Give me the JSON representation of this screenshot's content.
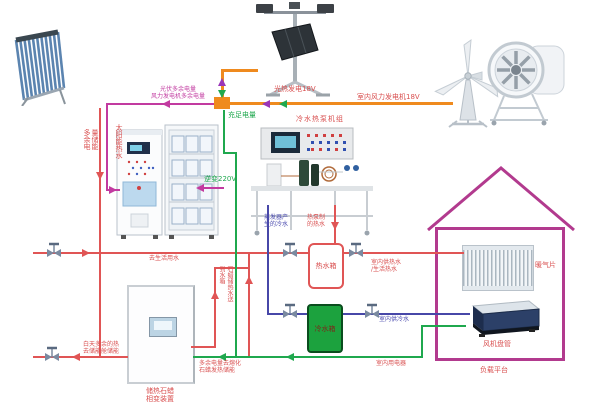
{
  "diagram": {
    "description": "solar-wind-heat-pump energy training system schematic",
    "labels": {
      "solar_hot_water": "太阳能热水",
      "surplus_to_battery": "光伏多余电量\n风力发电机多余电量",
      "surplus_storage": "多余电量储能",
      "solar_thermal_gen": "光热发电18V",
      "wind_gen": "室内风力发电机18V",
      "sufficient_power": "充足电量",
      "inverter_220v": "逆变220V",
      "heat_pump_unit": "冷水热泵机组",
      "evaporator_cold_water": "蒸发器产\n生的冷水",
      "heat_pump_hot_water": "热泵制\n的热水",
      "to_domestic_water": "去生活用水",
      "hot_water_tank": "热水箱",
      "cold_water_tank": "冷水箱",
      "paraffin_heat_to_tank": "石蜡储热水送到水箱",
      "day_surplus_heat": "白天多余的热\n去储能舱储能",
      "paraffin_device": "储热石蜡\n相变装置",
      "surplus_melt_paraffin": "多余电量去熔化\n石蜡发热储能",
      "indoor_hot_water": "室内供热水\n/生活热水",
      "indoor_cold_water": "室内供冷水",
      "indoor_appliances": "室内用电器",
      "radiator": "暖气片",
      "fan_coil": "风机盘管",
      "load_platform": "负载平台"
    },
    "colors": {
      "hot_water_line": "#E05555",
      "cold_water_line": "#4747A8",
      "power_green": "#1FA84E",
      "power_orange": "#EF8A1E",
      "power_magenta": "#C23AA0",
      "arrow_purple": "#9A35B8",
      "house_outline": "#B23A8E",
      "cold_tank_fill": "#1CA23E",
      "label_red": "#D95050"
    }
  }
}
